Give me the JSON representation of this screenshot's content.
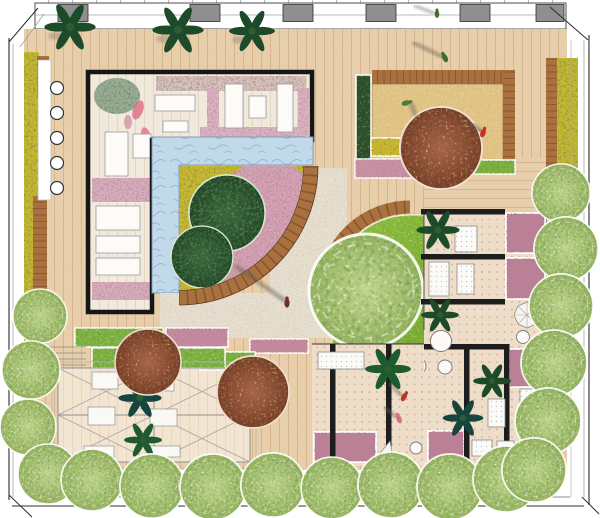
{
  "plan": {
    "label": "Courtyard garden landscape plan, top-down rendering",
    "canvas": {
      "width": 600,
      "height": 518
    }
  },
  "palette": {
    "deck_wood": "#e8cfab",
    "plank_line": "#bb9165",
    "water": "#c2d9ea",
    "water_line": "#8fb3d2",
    "lawn_green": "#86b737",
    "gravel": "#e7dfd0",
    "sand": "#e2c585",
    "timber_border": "#a9713f",
    "wall_black": "#1d1d1d",
    "flower_yellow": "#c9b82e",
    "flower_pink": "#c993a6",
    "hedge_green": "#7fb33c",
    "perimeter_tree": "#a8c472",
    "planter_tree_dark": "#2f5a33",
    "canopy_rust": "#95583a",
    "cabana_floor": "#eeddc8",
    "room_cream": "#f0e9dc",
    "furniture_white": "#fcfbf8",
    "column_gray": "#8f8f8f"
  },
  "zones": {
    "building_edge": {
      "label": "Building facade with columns and glazing"
    },
    "deck": {
      "label": "Timber deck"
    },
    "flower_border_left": {
      "label": "Yellow flower border with brick edge and stepping lights"
    },
    "lounge_room": {
      "label": "L-shaped lounge garden room with sunbeds and flower borders"
    },
    "water_feature": {
      "label": "Water feature pool"
    },
    "circular_planter": {
      "label": "Quarter-circle planter with evergreen trees, yellow and pink flowers"
    },
    "gravel_court": {
      "label": "Gravel courtyard"
    },
    "lawn": {
      "label": "Lawn with feature tree and timber edge"
    },
    "sand_court": {
      "label": "Sand play court with rust tree"
    },
    "cabana_rooms_east": {
      "label": "East cabana rooms with black walls"
    },
    "cabana_rooms_south": {
      "label": "South cabana rooms with black walls"
    },
    "pergola_terrace": {
      "label": "Pergola dining terrace with hedges and tables"
    },
    "perimeter_trees": {
      "label": "Perimeter street tree rows"
    }
  },
  "figures": {
    "label": "People figures on the plan",
    "count": 7
  }
}
